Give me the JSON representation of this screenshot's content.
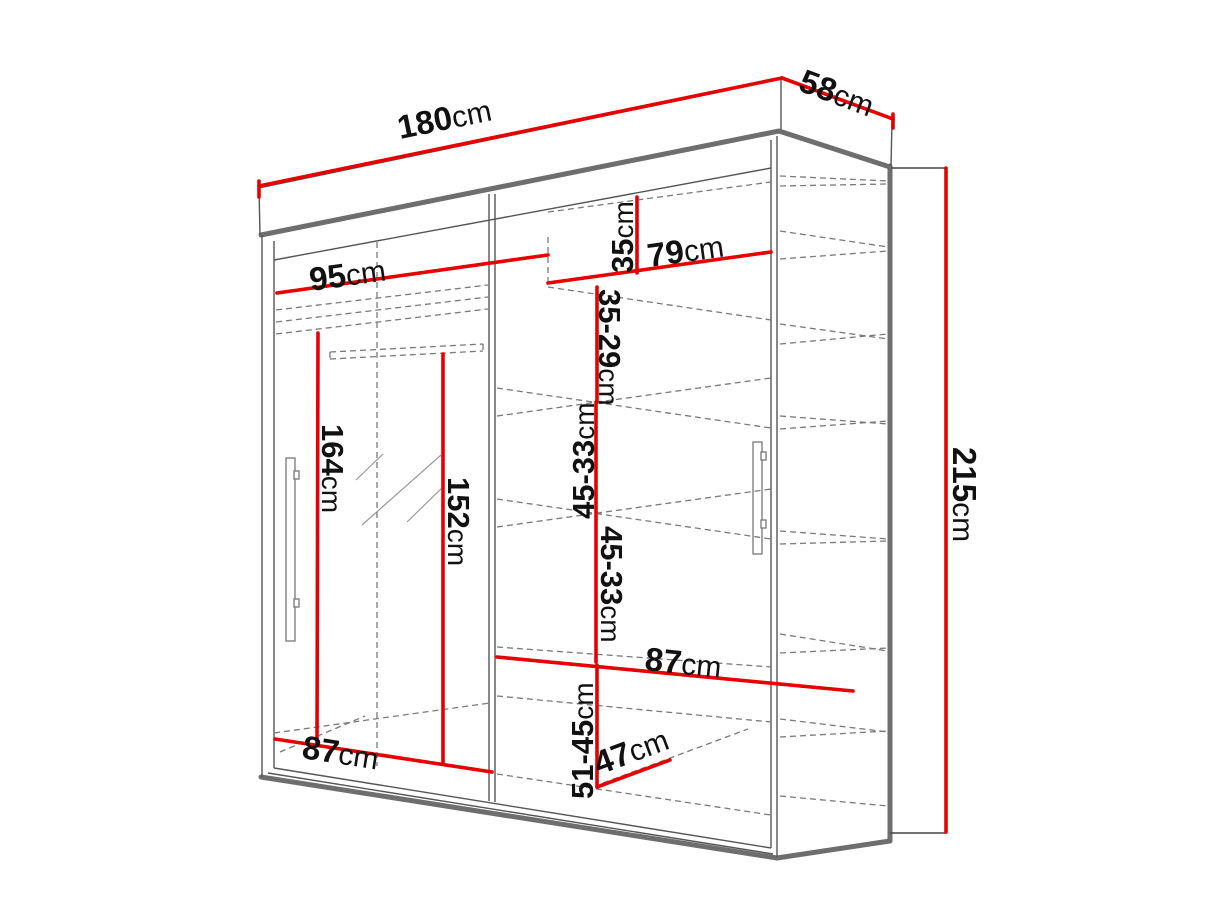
{
  "diagram": {
    "type": "furniture-dimension-diagram",
    "subject": "sliding-door wardrobe with mirror, perspective view with red dimension lines",
    "colors": {
      "dimension_line": "#e60000",
      "outline_thick": "#6e6e6e",
      "outline_thin": "#555555",
      "dashed_interior": "#7a7a7a",
      "label_text": "#111111",
      "background": "#ffffff"
    },
    "dimensions": {
      "width": {
        "num": "180",
        "unit": "cm"
      },
      "depth": {
        "num": "58",
        "unit": "cm"
      },
      "height": {
        "num": "215",
        "unit": "cm"
      },
      "top_left_width": {
        "num": "95",
        "unit": "cm"
      },
      "top_right_width": {
        "num": "79",
        "unit": "cm"
      },
      "top_shelf_height": {
        "num": "35",
        "unit": "cm"
      },
      "shelf_gap_upper": {
        "num": "35-29",
        "unit": "cm"
      },
      "shelf_gap_mid1": {
        "num": "45-33",
        "unit": "cm"
      },
      "shelf_gap_mid2": {
        "num": "45-33",
        "unit": "cm"
      },
      "shelf_gap_bottom": {
        "num": "51-45",
        "unit": "cm"
      },
      "hanging_height": {
        "num": "164",
        "unit": "cm"
      },
      "mirror_height": {
        "num": "152",
        "unit": "cm"
      },
      "middle_shelf_width": {
        "num": "87",
        "unit": "cm"
      },
      "bottom_left_width": {
        "num": "87",
        "unit": "cm"
      },
      "bottom_depth": {
        "num": "47",
        "unit": "cm"
      }
    }
  }
}
